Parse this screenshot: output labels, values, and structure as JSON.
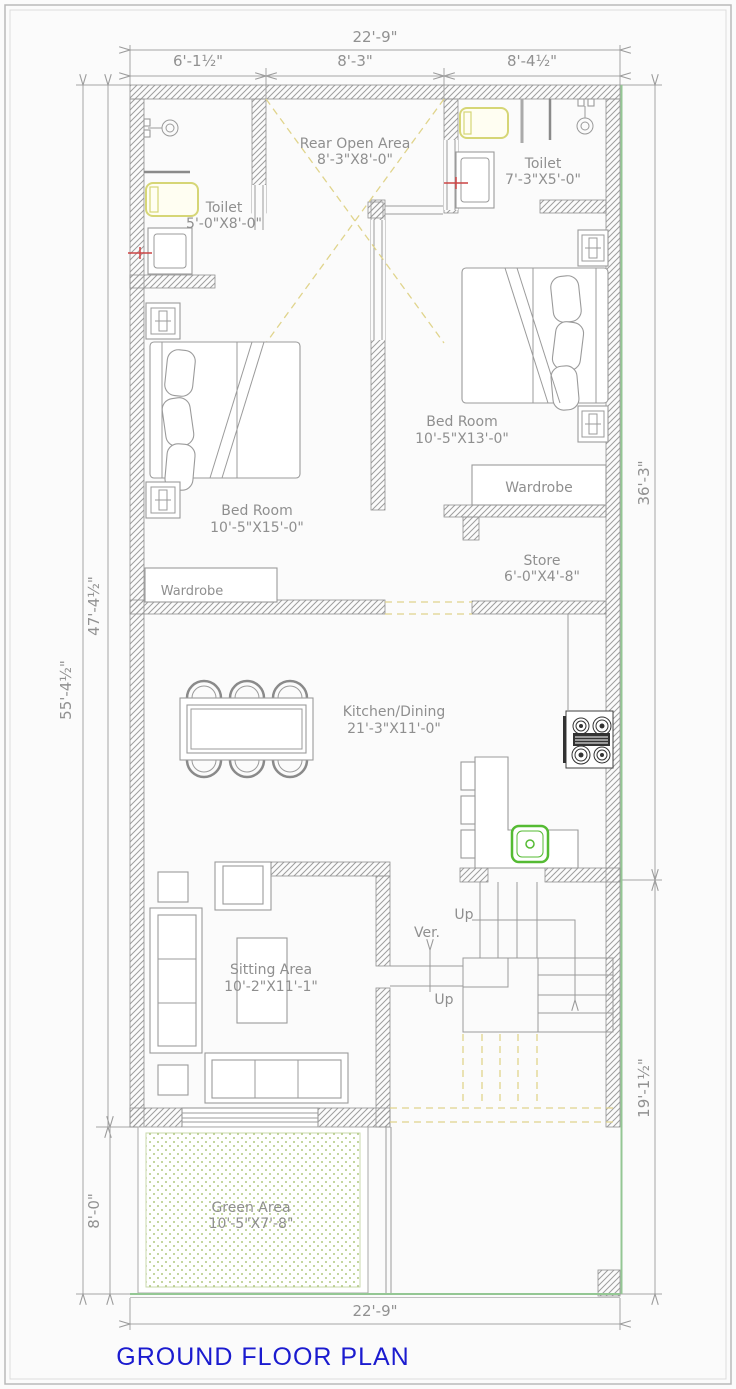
{
  "title": {
    "text": "GROUND FLOOR PLAN",
    "color": "#1b1bcf"
  },
  "dimensions": {
    "top_total": "22'-9\"",
    "top_seg_left": "6'-1½\"",
    "top_seg_mid": "8'-3\"",
    "top_seg_right": "8'-4½\"",
    "left_outer": "55'-4½\"",
    "left_inner": "47'-4½\"",
    "front_depth": "8'-0\"",
    "right_upper": "36'-3\"",
    "right_lower": "19'-1½\"",
    "bottom_total": "22'-9\""
  },
  "rooms": {
    "rear_open_area": {
      "name": "Rear Open Area",
      "size": "8'-3\"X8'-0\""
    },
    "toilet_left": {
      "name": "Toilet",
      "size": "5'-0\"X8'-0\""
    },
    "toilet_right": {
      "name": "Toilet",
      "size": "7'-3\"X5'-0\""
    },
    "bedroom_right": {
      "name": "Bed Room",
      "size": "10'-5\"X13'-0\""
    },
    "bedroom_left": {
      "name": "Bed Room",
      "size": "10'-5\"X15'-0\""
    },
    "wardrobe_right": {
      "name": "Wardrobe"
    },
    "wardrobe_left": {
      "name": "Wardrobe"
    },
    "store": {
      "name": "Store",
      "size": "6'-0\"X4'-8\""
    },
    "kitchen_dining": {
      "name": "Kitchen/Dining",
      "size": "21'-3\"X11'-0\""
    },
    "sitting_area": {
      "name": "Sitting Area",
      "size": "10'-2\"X11'-1\""
    },
    "green_area": {
      "name": "Green Area",
      "size": "10'-5\"X7'-8\""
    },
    "verandah": {
      "name": "Ver."
    }
  },
  "stairs": {
    "up_label_1": "Up",
    "up_label_2": "Up"
  },
  "colors": {
    "wall_hatch": "#9e9e9e",
    "drawing_line": "#9b9b9b",
    "label_text": "#8f8f8f",
    "title_blue": "#1b1bcf",
    "fixture_yellow": "#d6d676",
    "door_dash_yellow": "#e0d48c",
    "green_dots": "#9ab85c",
    "plot_green": "#94c794",
    "sink_green": "#55bb33",
    "marker_red": "#cc4444",
    "stove_dark": "#3a3a3a"
  }
}
